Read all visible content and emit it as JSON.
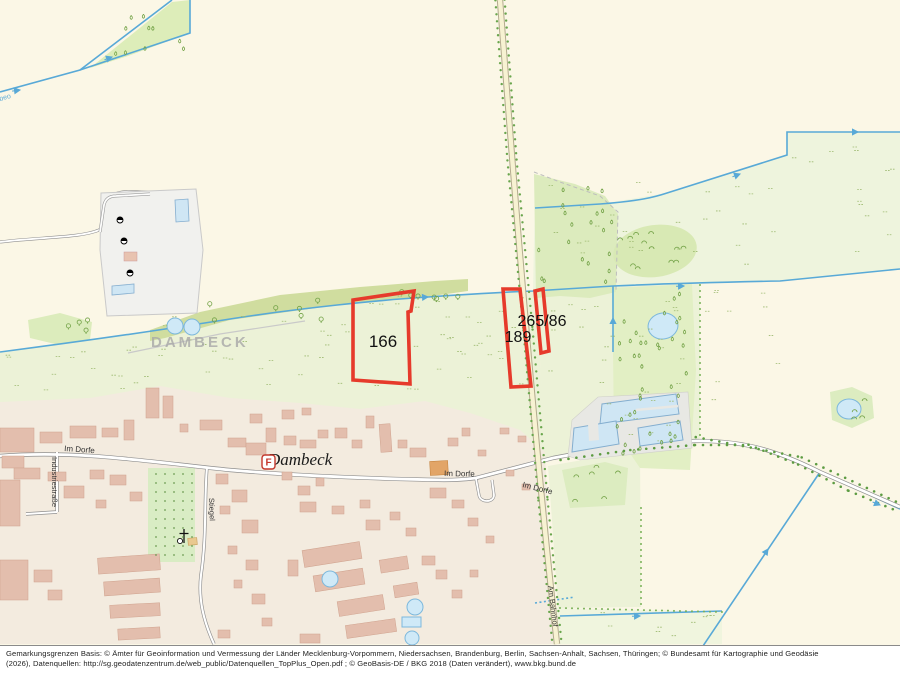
{
  "map": {
    "parcels": {
      "p166": "166",
      "p189": "189",
      "p265": "265/86"
    },
    "place": {
      "name": "Dambeck",
      "district": "DAMBECK"
    },
    "streets": {
      "im_dorfe": "Im Dorfe",
      "industriestrasse": "Industriestraße",
      "stiegel": "Stiegel",
      "am_bahnhof": "Am Bahnhof"
    },
    "water_label_fragment": "beo",
    "poi": {
      "fire_label": "F"
    },
    "colors": {
      "cream": "#fbf7e6",
      "village": "#f3ebdf",
      "pale_green": "#ecf2d7",
      "mid_green": "#dcebbd",
      "olive": "#d0dd9f",
      "water": "#58a9d7",
      "water_fill": "#cfe9f7",
      "road_yellow": "#f7f2d2",
      "building": "#e3bead",
      "parcel_red": "#e63a2b",
      "industrial_grey": "#f1f1ee"
    }
  },
  "attribution": {
    "line1": "Gemarkungsgrenzen Basis: © Ämter für Geoinformation und Vermessung der Länder Mecklenburg-Vorpommern, Niedersachsen, Brandenburg, Berlin, Sachsen-Anhalt, Sachsen, Thüringen; © Bundesamt für Kartographie und Geodäsie",
    "line2": "(2026), Datenquellen: http://sg.geodatenzentrum.de/web_public/Datenquellen_TopPlus_Open.pdf ; © GeoBasis-DE / BKG 2018 (Daten verändert), www.bkg.bund.de"
  }
}
